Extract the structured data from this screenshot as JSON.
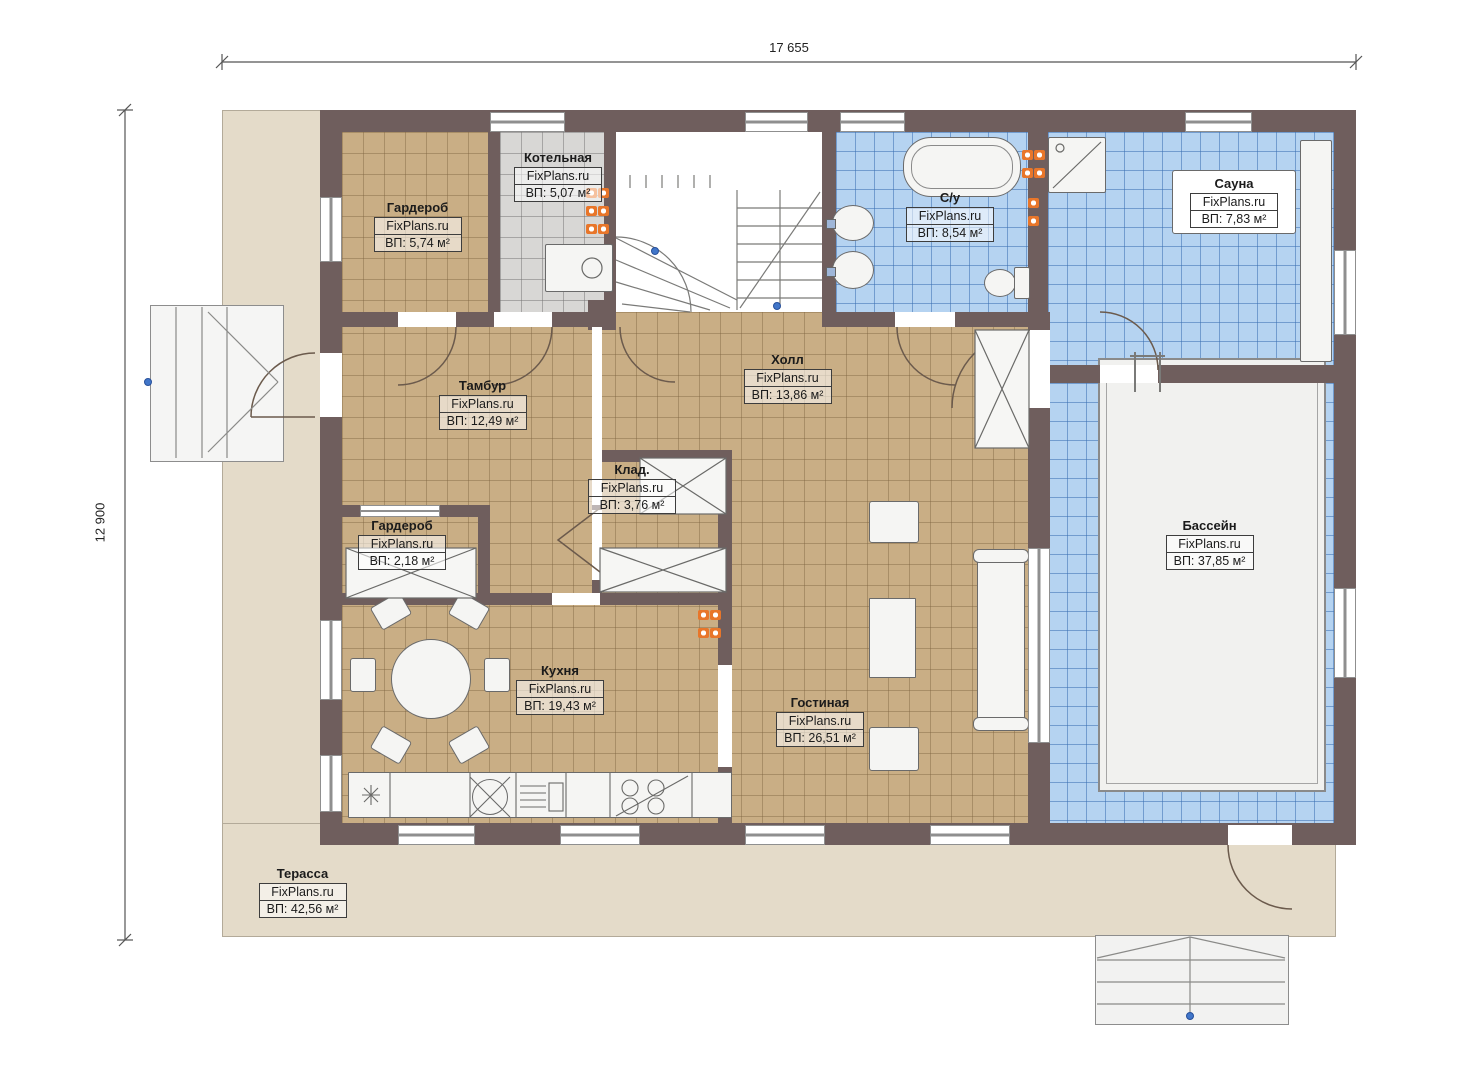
{
  "plan": {
    "dim_width": "17 655",
    "dim_height": "12 900",
    "brand": "FixPlans.ru"
  },
  "rooms": [
    {
      "id": "wardrobe-top",
      "name": "Гардероб",
      "brand": "FixPlans.ru",
      "area": "ВП: 5,74 м²"
    },
    {
      "id": "boiler",
      "name": "Котельная",
      "brand": "FixPlans.ru",
      "area": "ВП: 5,07 м²"
    },
    {
      "id": "bathroom",
      "name": "С/у",
      "brand": "FixPlans.ru",
      "area": "ВП: 8,54 м²"
    },
    {
      "id": "sauna",
      "name": "Сауна",
      "brand": "FixPlans.ru",
      "area": "ВП: 7,83 м²"
    },
    {
      "id": "vestibule",
      "name": "Тамбур",
      "brand": "FixPlans.ru",
      "area": "ВП: 12,49 м²"
    },
    {
      "id": "hall",
      "name": "Холл",
      "brand": "FixPlans.ru",
      "area": "ВП: 13,86 м²"
    },
    {
      "id": "storage",
      "name": "Клад.",
      "brand": "FixPlans.ru",
      "area": "ВП: 3,76 м²"
    },
    {
      "id": "wardrobe-small",
      "name": "Гардероб",
      "brand": "FixPlans.ru",
      "area": "ВП: 2,18 м²"
    },
    {
      "id": "kitchen",
      "name": "Кухня",
      "brand": "FixPlans.ru",
      "area": "ВП: 19,43 м²"
    },
    {
      "id": "living",
      "name": "Гостиная",
      "brand": "FixPlans.ru",
      "area": "ВП: 26,51 м²"
    },
    {
      "id": "pool",
      "name": "Бассейн",
      "brand": "FixPlans.ru",
      "area": "ВП: 37,85 м²"
    },
    {
      "id": "terrace",
      "name": "Терасса",
      "brand": "FixPlans.ru",
      "area": "ВП: 42,56 м²"
    }
  ],
  "colors": {
    "wall": "#6f5e5d",
    "floor_wood": "#c9ae85",
    "floor_gray": "#d8d7d5",
    "tile_blue": "#b5d3f1",
    "terrace": "#e4dbc9",
    "radiator_orange": "#e8762a",
    "node_marker_blue": "#4176c9"
  }
}
